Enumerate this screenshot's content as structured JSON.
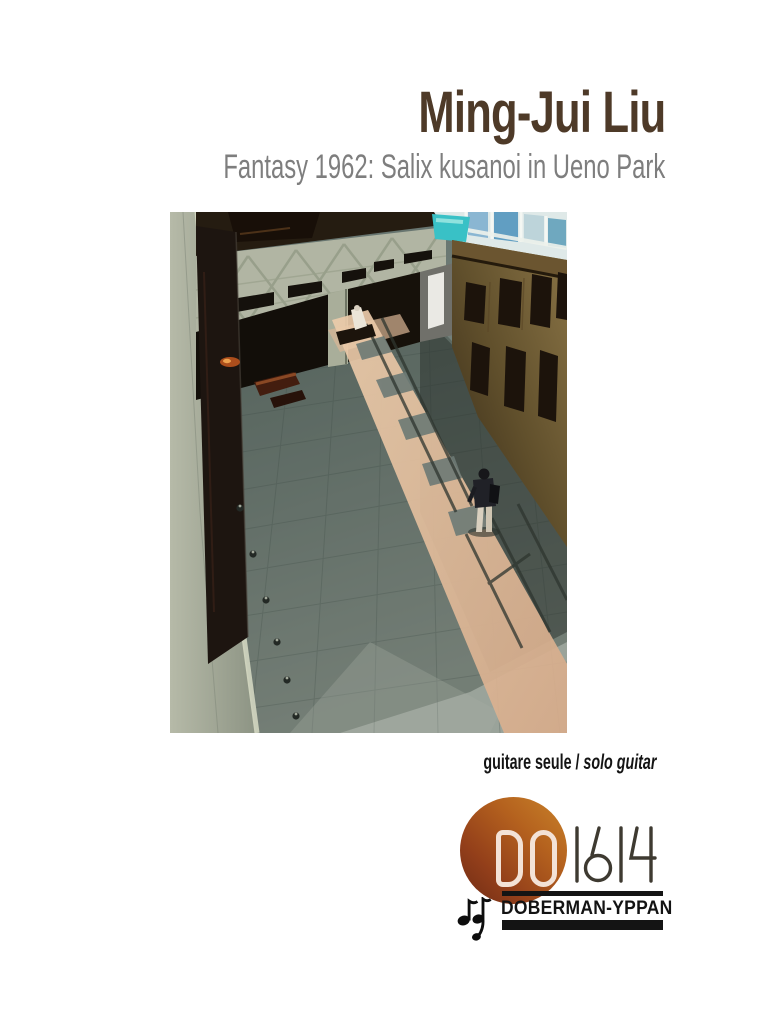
{
  "header": {
    "composer_name": "Ming-Jui Liu",
    "work_title": "Fantasy 1962: Salix kusanoi in Ueno Park",
    "composer_color": "#4e3a28",
    "work_title_color": "#7e7e7e"
  },
  "cover_photo": {
    "description": "Overhead view of a museum atrium: grey-green marble walls, a dark tall panel, wooden panelled wall, and diagonal sunlight streaks across a tiled floor with a lone visitor",
    "palette": {
      "floor": "#75827c",
      "marble": "#b1b5a3",
      "wood": "#7d6840",
      "sunlight": "#e0bb9b",
      "teal_accent": "#39c1c6",
      "shadow": "#16110a"
    }
  },
  "instrumentation": {
    "french_label": "guitare seule",
    "separator": " / ",
    "english_label": "solo guitar"
  },
  "publisher_logo": {
    "catalog_prefix": "DO",
    "catalog_number": "1614",
    "publisher_name": "DOBERMAN-YPPAN",
    "music_note_icon": "eighth-notes-dy-monogram",
    "colors": {
      "circle_gradient_start": "#c9832a",
      "circle_gradient_end": "#6e2b16",
      "catalog_prefix_outline": "#f3e2d6",
      "catalog_number_ink": "#3e3a31",
      "bars_and_text_ink": "#141414"
    }
  }
}
